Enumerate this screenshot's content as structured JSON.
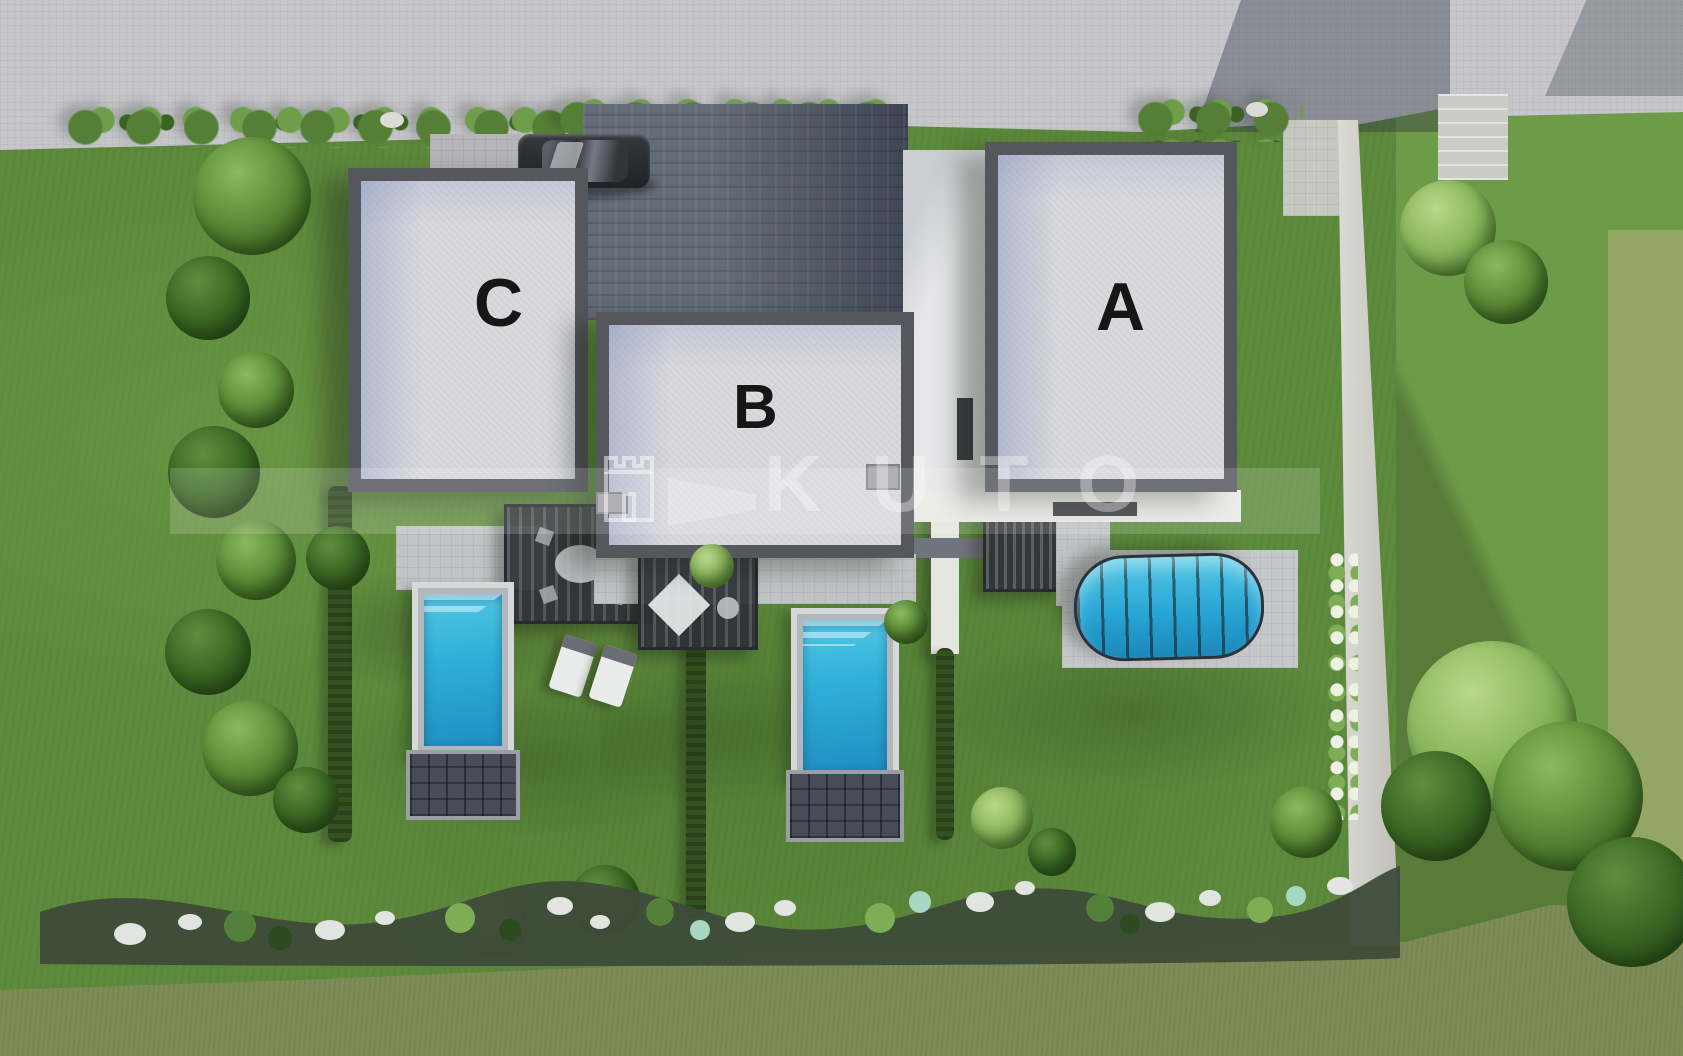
{
  "scene": {
    "type": "3D aerial architectural rendering",
    "description": "Top-down visualization of a residential development with three modern flat-roof villas labelled A, B and C, each with a private fenced garden and swimming pool, accessed from a light paved street at the top via a dark block-paved driveway.",
    "buildings": [
      {
        "id": "villa-c",
        "label": "C",
        "position": "left",
        "garden_features": [
          "rectangular pool with slatted end platform",
          "pergola with outdoor dining set",
          "two sun loungers"
        ]
      },
      {
        "id": "villa-b",
        "label": "B",
        "position": "center",
        "garden_features": [
          "rectangular pool with slatted end platform",
          "pergola terrace with parasol"
        ]
      },
      {
        "id": "villa-a",
        "label": "A",
        "position": "right",
        "garden_features": [
          "pool covered by arched glazed enclosure",
          "pergola terrace beside house"
        ]
      }
    ],
    "site": {
      "street": "light paved road along the top edge",
      "driveway": "dark block paving between villas C and A",
      "vehicle": "dark parked car on the driveway",
      "boundaries": [
        "hedgerows between the three gardens",
        "concrete boundary wall on the right",
        "row of trees along the left side",
        "wavy rock-garden border with white stones along the bottom",
        "rough meadow strip at the bottom edge"
      ]
    },
    "watermark": {
      "text": "KUTO",
      "logo": "castle-emblem"
    },
    "palette": {
      "lawn": "#5c8a3b",
      "neighbor_lawn": "#6e9b46",
      "meadow": "#7e8d56",
      "road": "#c8c8cc",
      "driveway": "#646c78",
      "roof": "#dadade",
      "parapet": "#54565c",
      "pool_water": "#2fb2da",
      "label_color": "#141414",
      "watermark_color": "rgba(255,255,255,0.36)"
    }
  }
}
